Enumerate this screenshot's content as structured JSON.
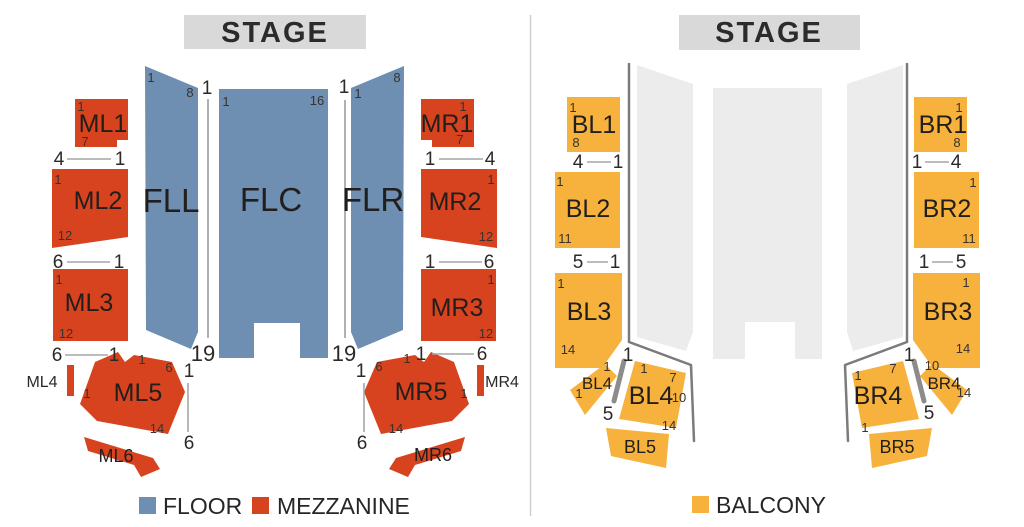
{
  "legend": {
    "floor": {
      "label": "FLOOR",
      "color": "#6e8fb2"
    },
    "mezzanine": {
      "label": "MEZZANINE",
      "color": "#d8431f"
    },
    "balcony": {
      "label": "BALCONY",
      "color": "#f6b23c"
    }
  },
  "left_panel": {
    "stage_label": "STAGE",
    "section_labels": {
      "FLL": "FLL",
      "FLC": "FLC",
      "FLR": "FLR",
      "ML1": "ML1",
      "ML2": "ML2",
      "ML3": "ML3",
      "ML4": "ML4",
      "ML5": "ML5",
      "ML6": "ML6",
      "MR1": "MR1",
      "MR2": "MR2",
      "MR3": "MR3",
      "MR4": "MR4",
      "MR5": "MR5",
      "MR6": "MR6"
    },
    "numbers": [
      {
        "t": "1",
        "x": 151,
        "y": 82
      },
      {
        "t": "8",
        "x": 190,
        "y": 97
      },
      {
        "t": "1",
        "x": 207,
        "y": 94,
        "s": "lg"
      },
      {
        "t": "1",
        "x": 226,
        "y": 106
      },
      {
        "t": "16",
        "x": 317,
        "y": 105
      },
      {
        "t": "1",
        "x": 344,
        "y": 93,
        "s": "lg"
      },
      {
        "t": "1",
        "x": 358,
        "y": 98
      },
      {
        "t": "8",
        "x": 397,
        "y": 82
      },
      {
        "t": "19",
        "x": 203,
        "y": 361,
        "s": "xl"
      },
      {
        "t": "19",
        "x": 344,
        "y": 361,
        "s": "xl"
      },
      {
        "t": "1",
        "x": 81,
        "y": 111
      },
      {
        "t": "7",
        "x": 85,
        "y": 146
      },
      {
        "t": "4",
        "x": 59,
        "y": 165,
        "s": "lg"
      },
      {
        "t": "1",
        "x": 120,
        "y": 165,
        "s": "lg"
      },
      {
        "t": "1",
        "x": 58,
        "y": 184
      },
      {
        "t": "12",
        "x": 65,
        "y": 240
      },
      {
        "t": "6",
        "x": 58,
        "y": 268,
        "s": "lg"
      },
      {
        "t": "1",
        "x": 119,
        "y": 268,
        "s": "lg"
      },
      {
        "t": "1",
        "x": 59,
        "y": 284
      },
      {
        "t": "12",
        "x": 66,
        "y": 338
      },
      {
        "t": "6",
        "x": 57,
        "y": 361,
        "s": "lg"
      },
      {
        "t": "1",
        "x": 114,
        "y": 361,
        "s": "lg"
      },
      {
        "t": "1",
        "x": 142,
        "y": 364
      },
      {
        "t": "6",
        "x": 169,
        "y": 372
      },
      {
        "t": "1",
        "x": 87,
        "y": 398
      },
      {
        "t": "14",
        "x": 157,
        "y": 433
      },
      {
        "t": "1",
        "x": 189,
        "y": 377,
        "s": "lg"
      },
      {
        "t": "6",
        "x": 189,
        "y": 449,
        "s": "lg"
      },
      {
        "t": "1",
        "x": 463,
        "y": 111
      },
      {
        "t": "7",
        "x": 460,
        "y": 144
      },
      {
        "t": "1",
        "x": 430,
        "y": 165,
        "s": "lg"
      },
      {
        "t": "4",
        "x": 490,
        "y": 165,
        "s": "lg"
      },
      {
        "t": "1",
        "x": 491,
        "y": 184
      },
      {
        "t": "12",
        "x": 486,
        "y": 241
      },
      {
        "t": "1",
        "x": 430,
        "y": 268,
        "s": "lg"
      },
      {
        "t": "6",
        "x": 489,
        "y": 268,
        "s": "lg"
      },
      {
        "t": "1",
        "x": 491,
        "y": 284
      },
      {
        "t": "12",
        "x": 486,
        "y": 338
      },
      {
        "t": "1",
        "x": 421,
        "y": 360,
        "s": "lg"
      },
      {
        "t": "6",
        "x": 482,
        "y": 360,
        "s": "lg"
      },
      {
        "t": "6",
        "x": 379,
        "y": 371
      },
      {
        "t": "1",
        "x": 407,
        "y": 363
      },
      {
        "t": "1",
        "x": 464,
        "y": 398
      },
      {
        "t": "14",
        "x": 396,
        "y": 433
      },
      {
        "t": "1",
        "x": 361,
        "y": 377,
        "s": "lg"
      },
      {
        "t": "6",
        "x": 362,
        "y": 449,
        "s": "lg"
      }
    ]
  },
  "right_panel": {
    "stage_label": "STAGE",
    "section_labels": {
      "BL1": "BL1",
      "BL2": "BL2",
      "BL3": "BL3",
      "BL4": "BL4",
      "BL4_SMALL": "BL4",
      "BL5": "BL5",
      "BR1": "BR1",
      "BR2": "BR2",
      "BR3": "BR3",
      "BR4": "BR4",
      "BR4_SMALL": "BR4",
      "BR5": "BR5"
    },
    "numbers": [
      {
        "t": "1",
        "x": 573,
        "y": 112
      },
      {
        "t": "8",
        "x": 576,
        "y": 147
      },
      {
        "t": "4",
        "x": 578,
        "y": 168,
        "s": "lg"
      },
      {
        "t": "1",
        "x": 618,
        "y": 168,
        "s": "lg"
      },
      {
        "t": "1",
        "x": 560,
        "y": 186
      },
      {
        "t": "11",
        "x": 565,
        "y": 243
      },
      {
        "t": "5",
        "x": 578,
        "y": 268,
        "s": "lg"
      },
      {
        "t": "1",
        "x": 615,
        "y": 268,
        "s": "lg"
      },
      {
        "t": "1",
        "x": 561,
        "y": 288
      },
      {
        "t": "14",
        "x": 568,
        "y": 354
      },
      {
        "t": "1",
        "x": 607,
        "y": 371
      },
      {
        "t": "1",
        "x": 579,
        "y": 398
      },
      {
        "t": "1",
        "x": 628,
        "y": 361,
        "s": "lg"
      },
      {
        "t": "5",
        "x": 608,
        "y": 420,
        "s": "lg"
      },
      {
        "t": "1",
        "x": 644,
        "y": 373
      },
      {
        "t": "7",
        "x": 673,
        "y": 382
      },
      {
        "t": "10",
        "x": 679,
        "y": 402
      },
      {
        "t": "14",
        "x": 669,
        "y": 430
      },
      {
        "t": "1",
        "x": 959,
        "y": 112
      },
      {
        "t": "8",
        "x": 957,
        "y": 147
      },
      {
        "t": "1",
        "x": 917,
        "y": 168,
        "s": "lg"
      },
      {
        "t": "4",
        "x": 956,
        "y": 168,
        "s": "lg"
      },
      {
        "t": "1",
        "x": 973,
        "y": 187
      },
      {
        "t": "11",
        "x": 969,
        "y": 243
      },
      {
        "t": "1",
        "x": 924,
        "y": 268,
        "s": "lg"
      },
      {
        "t": "5",
        "x": 961,
        "y": 268,
        "s": "lg"
      },
      {
        "t": "1",
        "x": 966,
        "y": 287
      },
      {
        "t": "14",
        "x": 963,
        "y": 353
      },
      {
        "t": "7",
        "x": 893,
        "y": 373
      },
      {
        "t": "1",
        "x": 858,
        "y": 380
      },
      {
        "t": "1",
        "x": 865,
        "y": 432
      },
      {
        "t": "1",
        "x": 909,
        "y": 361,
        "s": "lg"
      },
      {
        "t": "5",
        "x": 929,
        "y": 419,
        "s": "lg"
      },
      {
        "t": "10",
        "x": 932,
        "y": 370
      },
      {
        "t": "14",
        "x": 964,
        "y": 397
      }
    ]
  }
}
